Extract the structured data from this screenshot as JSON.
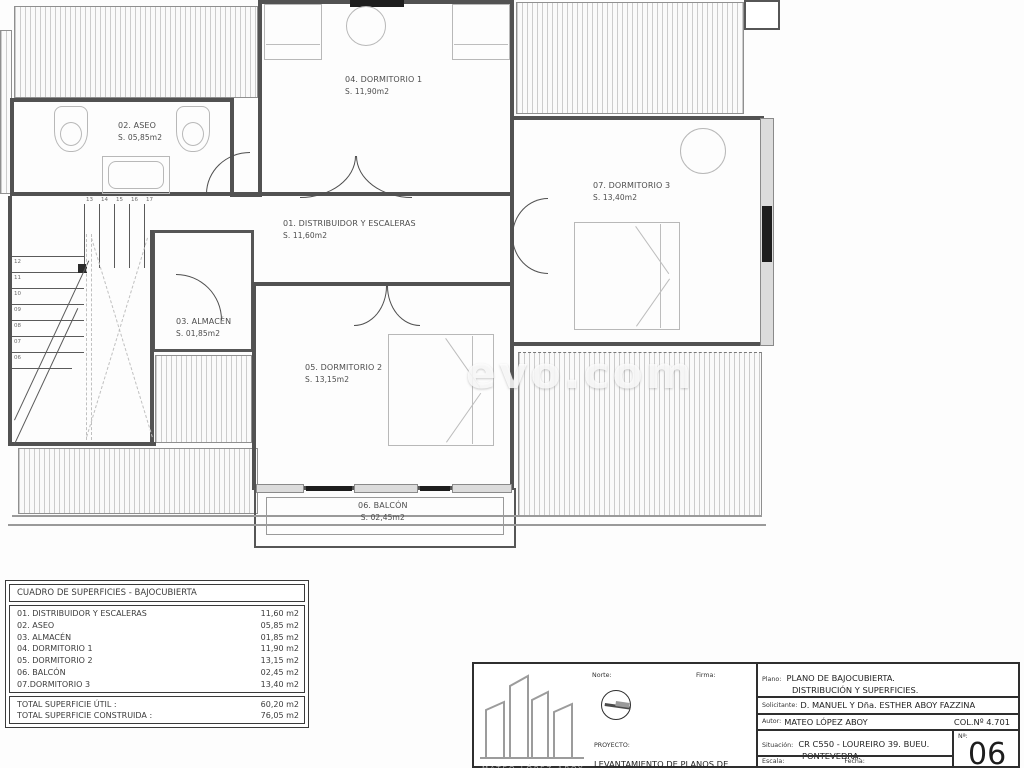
{
  "watermark": "evo.com",
  "plan": {
    "rooms": [
      {
        "name": "01. DISTRIBUIDOR Y ESCALERAS",
        "area": "S. 11,60m2"
      },
      {
        "name": "02. ASEO",
        "area": "S. 05,85m2"
      },
      {
        "name": "03. ALMACÉN",
        "area": "S. 01,85m2"
      },
      {
        "name": "04. DORMITORIO 1",
        "area": "S. 11,90m2"
      },
      {
        "name": "05. DORMITORIO 2",
        "area": "S. 13,15m2"
      },
      {
        "name": "06. BALCÓN",
        "area": "S. 02,45m2"
      },
      {
        "name": "07. DORMITORIO 3",
        "area": "S. 13,40m2"
      }
    ],
    "stairs": {
      "top_numbers": [
        "13",
        "14",
        "15",
        "16",
        "17"
      ],
      "left_numbers": [
        "12",
        "11",
        "10",
        "09",
        "08",
        "07",
        "06"
      ]
    }
  },
  "surface_table": {
    "title": "CUADRO DE SUPERFICIES - BAJOCUBIERTA",
    "rows": [
      {
        "label": "01. DISTRIBUIDOR Y ESCALERAS",
        "value": "11,60 m2"
      },
      {
        "label": "02. ASEO",
        "value": "05,85 m2"
      },
      {
        "label": "03. ALMACÉN",
        "value": "01,85 m2"
      },
      {
        "label": "04. DORMITORIO 1",
        "value": "11,90 m2"
      },
      {
        "label": "05. DORMITORIO 2",
        "value": "13,15 m2"
      },
      {
        "label": "06. BALCÓN",
        "value": "02,45 m2"
      },
      {
        "label": "07.DORMITORIO 3",
        "value": "13,40 m2"
      }
    ],
    "totals": [
      {
        "label": "TOTAL SUPERFICIE ÚTIL :",
        "value": "60,20 m2"
      },
      {
        "label": "TOTAL SUPERFICIE CONSTRUIDA :",
        "value": "76,05 m2"
      }
    ]
  },
  "title_block": {
    "norte_label": "Norte:",
    "firma_label": "Firma:",
    "proyecto_label": "PROYECTO:",
    "proyecto_text": "LEVANTAMIENTO DE PLANOS DE",
    "logo_caption": "MATEO LÓPEZ ABOY",
    "plano_label": "Plano:",
    "plano_line1": "PLANO DE BAJOCUBIERTA.",
    "plano_line2": "DISTRIBUCIÓN Y SUPERFICIES.",
    "solicitante_label": "Solicitante:",
    "solicitante_value": "D. MANUEL Y Dña. ESTHER ABOY FAZZINA",
    "autor_label": "Autor:",
    "autor_value": "MATEO LÓPEZ ABOY",
    "col_value": "COL.Nº 4.701",
    "situacion_label": "Situación:",
    "situacion_line1": "CR C550 - LOUREIRO 39. BUEU.",
    "situacion_line2": "PONTEVEDRA.",
    "numero_label": "Nª:",
    "numero_value": "06",
    "escala_label": "Escala:",
    "fecha_label": "Fecha:"
  }
}
